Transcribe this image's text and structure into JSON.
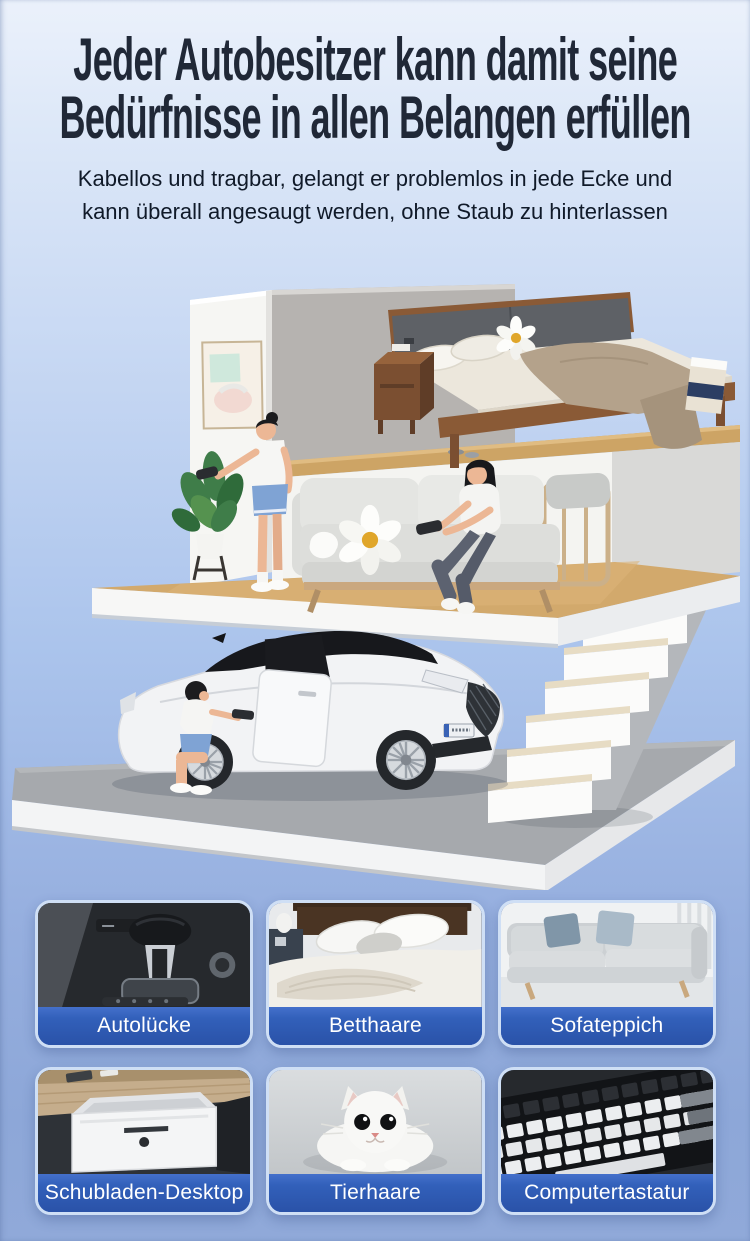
{
  "header": {
    "title_line1": "Jeder Autobesitzer kann damit seine",
    "title_line2": "Bedürfnisse in allen Belangen erfüllen",
    "subtitle_line1": "Kabellos und tragbar, gelangt er problemlos in jede Ecke und",
    "subtitle_line2": "kann überall angesaugt werden, ohne Staub zu hinterlassen"
  },
  "scene": {
    "alt": "Isometrische Schnittansicht: Schlafzimmer mit Bett oben, Wohnzimmer mit Sofa und zwei Frauen mit Handstaubsauger, Treppe und weißes Auto auf grauer Plattform"
  },
  "tiles": [
    {
      "label": "Autolücke",
      "image": "car-gear-console-photo"
    },
    {
      "label": "Betthaare",
      "image": "bed-blanket-photo"
    },
    {
      "label": "Sofateppich",
      "image": "gray-sofa-photo"
    },
    {
      "label": "Schubladen-Desktop",
      "image": "desk-drawer-photo"
    },
    {
      "label": "Tierhaare",
      "image": "white-cat-photo"
    },
    {
      "label": "Computertastatur",
      "image": "keyboard-photo"
    }
  ],
  "colors": {
    "headline": "#202837",
    "subtitle": "#101a29",
    "background_top": "#ebf1fb",
    "background_bottom": "#90a9d9",
    "tile_label_background": "#2e5ab3",
    "tile_border": "#cfdff5"
  }
}
